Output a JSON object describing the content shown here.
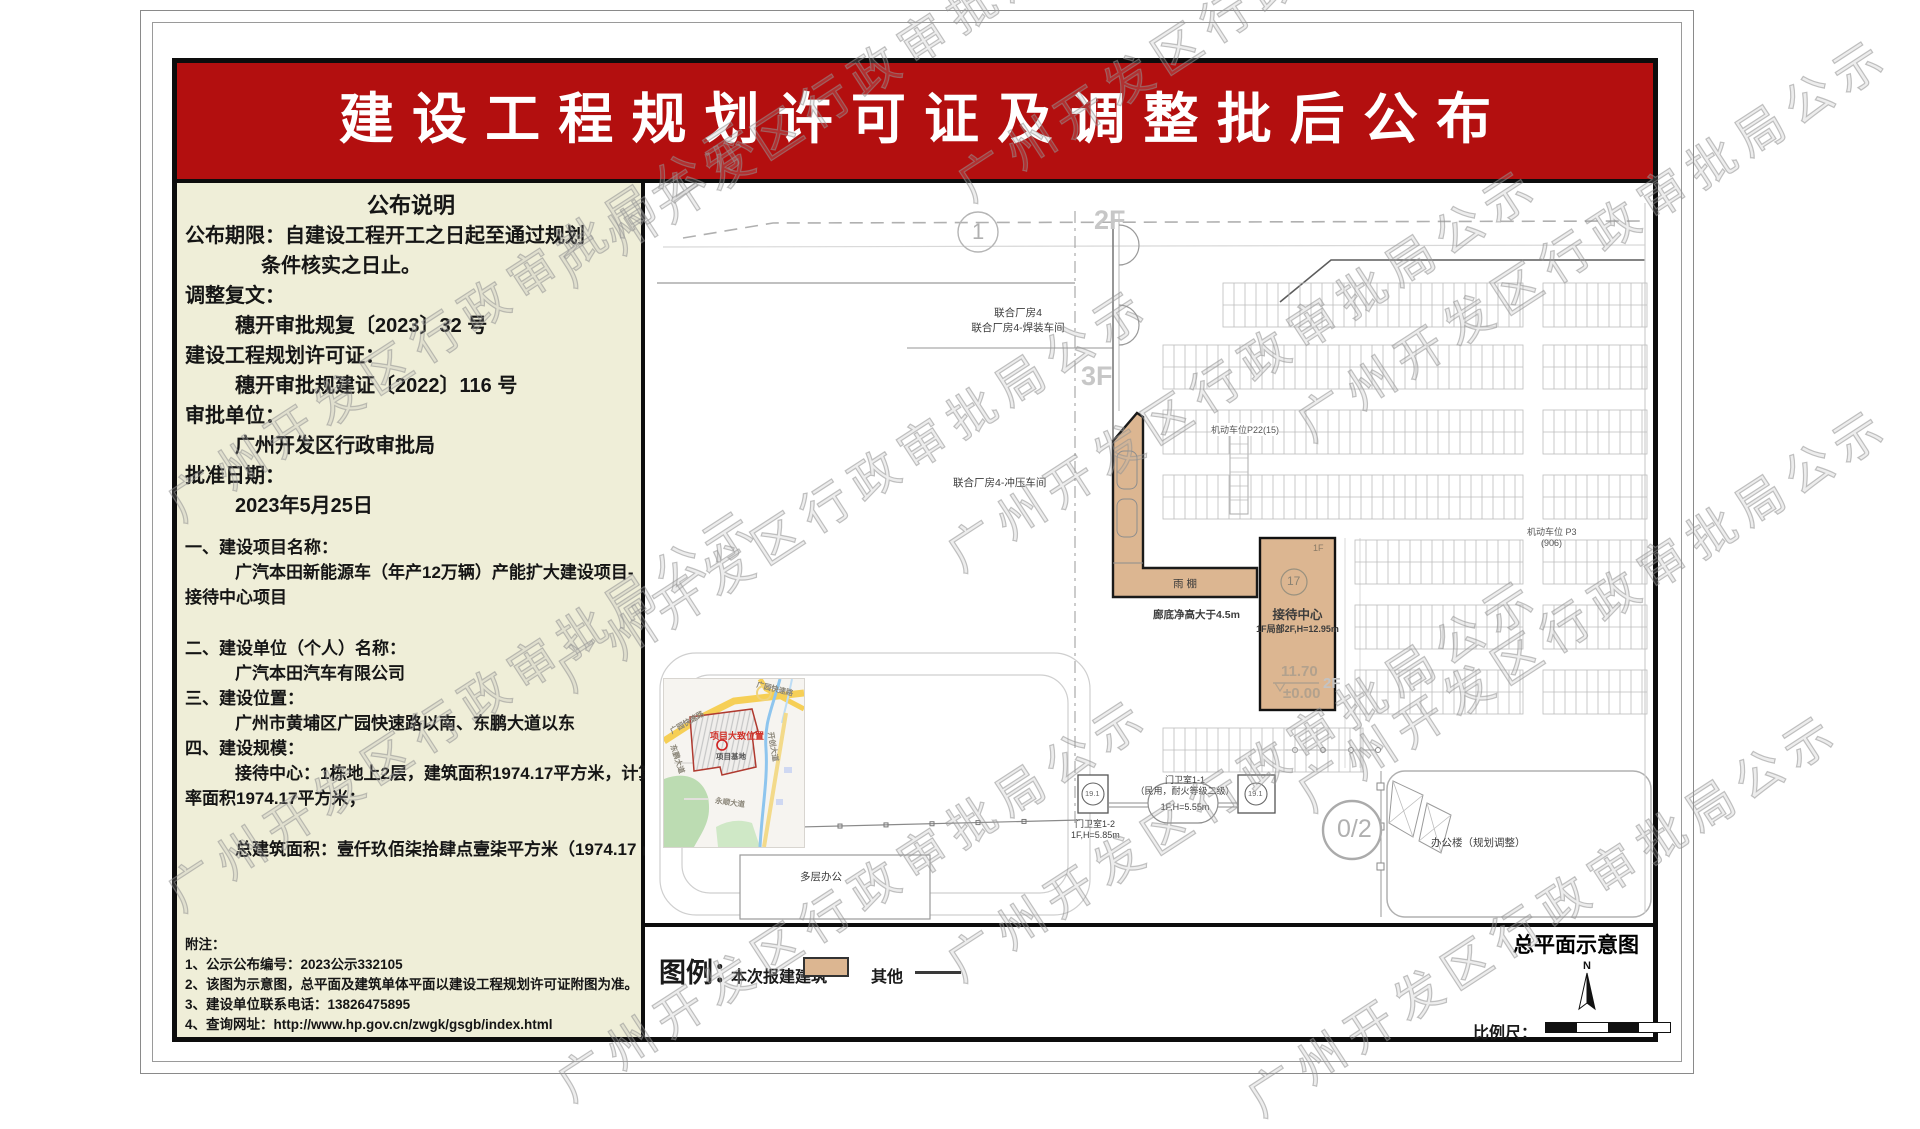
{
  "doc": {
    "title": "建设工程规划许可证及调整批后公布",
    "watermark_text": "广州开发区行政审批局公示"
  },
  "left_panel": {
    "lines": [
      {
        "text": "公布说明",
        "cls": "s22 ctr"
      },
      {
        "text": "公布期限：自建设工程开工之日起至通过规划",
        "cls": "s20"
      },
      {
        "text": "条件核实之日止。",
        "cls": "s20 ind2"
      },
      {
        "text": "调整复文：",
        "cls": "s20"
      },
      {
        "text": "穗开审批规复〔2023〕32 号",
        "cls": "s20 ind1"
      },
      {
        "text": "建设工程规划许可证：",
        "cls": "s20"
      },
      {
        "text": "穗开审批规建证〔2022〕116 号",
        "cls": "s20 ind1"
      },
      {
        "text": "审批单位：",
        "cls": "s20"
      },
      {
        "text": "广州开发区行政审批局",
        "cls": "s20 ind1"
      },
      {
        "text": "批准日期：",
        "cls": "s20"
      },
      {
        "text": "2023年5月25日",
        "cls": "s20 ind1"
      },
      {
        "text": "一、建设项目名称：",
        "cls": "s17 mt"
      },
      {
        "text": "广汽本田新能源车（年产12万辆）产能扩大建设项目-",
        "cls": "s17 ind1"
      },
      {
        "text": "接待中心项目",
        "cls": "s17"
      },
      {
        "text": "二、建设单位（个人）名称：",
        "cls": "s17 mt2"
      },
      {
        "text": "广汽本田汽车有限公司",
        "cls": "s17 ind1"
      },
      {
        "text": "三、建设位置：",
        "cls": "s17"
      },
      {
        "text": "广州市黄埔区广园快速路以南、东鹏大道以东",
        "cls": "s17 ind1"
      },
      {
        "text": "四、建设规模：",
        "cls": "s17"
      },
      {
        "text": "接待中心：1栋地上2层，建筑面积1974.17平方米，计算容积",
        "cls": "s17 ind1"
      },
      {
        "text": "率面积1974.17平方米；",
        "cls": "s17"
      },
      {
        "text": "总建筑面积：壹仟玖佰柒拾肆点壹柒平方米（1974.17 ㎡）。",
        "cls": "s17 ind1 mt2"
      }
    ],
    "notes": [
      {
        "text": "附注：",
        "cls": ""
      },
      {
        "text": "1、公示公布编号：2023公示332105",
        "cls": ""
      },
      {
        "text": "2、该图为示意图，总平面及建筑单体平面以建设工程规划许可证附图为准。",
        "cls": ""
      },
      {
        "text": "3、建设单位联系电话：13826475895",
        "cls": ""
      },
      {
        "text": "4、查询网址：http://www.hp.gov.cn/zwgk/gsgb/index.html",
        "cls": ""
      }
    ]
  },
  "plan": {
    "caption": "总平面示意图",
    "labels": {
      "grid_circle_1": "1",
      "floor_2f": "2F",
      "floor_3f": "3F",
      "workshop_line1": "联合厂房4",
      "workshop_line2": "联合厂房4-焊装车间",
      "workshop_stamping": "联合厂房4-冲压车间",
      "canopy": "雨棚",
      "canopy_clearance": "廊底净高大于4.5m",
      "parking_p22": "机动车位P22(15)",
      "parking_p3_line1": "机动车位 P3",
      "parking_p3_line2": "(906)",
      "reception_floor_tag": "1F",
      "reception_circle": "17",
      "reception_name": "接待中心",
      "reception_spec": "1F局部2F,H=12.95m",
      "elevation_top": "11.70",
      "elevation_bottom": "±0.00",
      "reception_2f_tag": "2F",
      "gatehouse1_line1": "门卫室1-1",
      "gatehouse1_line2": "（民用，耐火等级二级）",
      "gatehouse1_line3": "1F,H=5.55m",
      "gatehouse2_line1": "门卫室1-2",
      "gatehouse2_line2": "1F,H=5.85m",
      "gate_circle_a": "19.1",
      "gate_circle_b": "19.1",
      "multi_office": "多层办公",
      "office_adjust": "办公楼（规划调整）",
      "circle_02": "0/2"
    }
  },
  "legend": {
    "label": "图例：",
    "new_building": "本次报建建筑",
    "other": "其他",
    "scale_label": "比例尺：",
    "north": "N",
    "new_building_color": "#dcb691"
  },
  "inset_map": {
    "note": "项目大致位置",
    "site_label": "项目基地",
    "roads": {
      "guangyuan_1": "广园快速路",
      "guangyuan_2": "广园快速路",
      "dongpeng": "东鹏大道",
      "kaichuang": "开创大道",
      "yongshun": "永顺大道"
    }
  },
  "colors": {
    "banner_red": "#b30f0f",
    "panel_beige": "#efeed8",
    "building_tan": "#dcb691"
  }
}
